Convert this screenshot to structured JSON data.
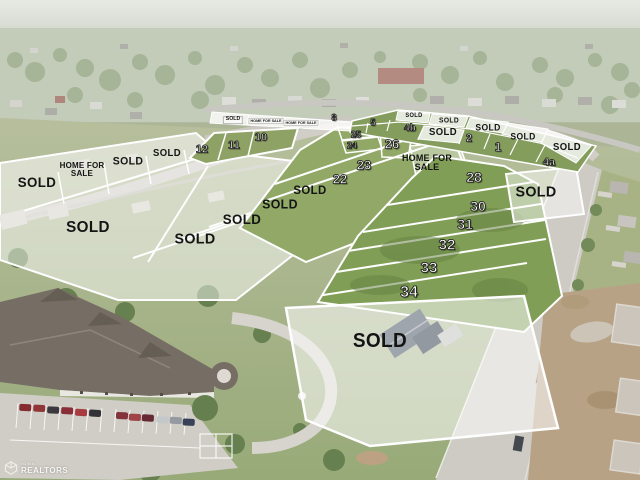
{
  "watermark": {
    "org_small": "IOWA",
    "org": "REALTORS"
  },
  "colors": {
    "lot_line": "#ffffff",
    "sold_overlay": "rgba(255,255,255,0.5)",
    "available_lot_green": "#7e9854",
    "label_black": "#141414",
    "lot_number_white": "#ffffff"
  },
  "labels": [
    {
      "text": "SOLD",
      "kind": "sign-sold",
      "x": 233,
      "y": 120,
      "size": 5.5
    },
    {
      "text": "HOME FOR SALE",
      "kind": "sign-hfs",
      "x": 266,
      "y": 121,
      "size": 6
    },
    {
      "text": "HOME FOR SALE",
      "kind": "sign-hfs",
      "x": 301,
      "y": 123,
      "size": 6
    },
    {
      "text": "8",
      "kind": "num",
      "x": 334,
      "y": 118,
      "size": 9
    },
    {
      "text": "5",
      "kind": "num",
      "x": 373,
      "y": 123,
      "size": 9
    },
    {
      "text": "SOLD",
      "kind": "sold",
      "x": 414,
      "y": 116,
      "size": 6
    },
    {
      "text": "4b",
      "kind": "num",
      "x": 410,
      "y": 129,
      "size": 10
    },
    {
      "text": "SOLD",
      "kind": "sold",
      "x": 449,
      "y": 121,
      "size": 7
    },
    {
      "text": "SOLD",
      "kind": "sold",
      "x": 443,
      "y": 133,
      "size": 10
    },
    {
      "text": "2",
      "kind": "num",
      "x": 469,
      "y": 139,
      "size": 11
    },
    {
      "text": "SOLD",
      "kind": "sold",
      "x": 488,
      "y": 128,
      "size": 9
    },
    {
      "text": "1",
      "kind": "num",
      "x": 498,
      "y": 147,
      "size": 12
    },
    {
      "text": "SOLD",
      "kind": "sold",
      "x": 523,
      "y": 137,
      "size": 9
    },
    {
      "text": "SOLD",
      "kind": "sold",
      "x": 567,
      "y": 148,
      "size": 10
    },
    {
      "text": "4a",
      "kind": "num",
      "x": 549,
      "y": 163,
      "size": 11
    },
    {
      "text": "10",
      "kind": "num",
      "x": 261,
      "y": 138,
      "size": 11
    },
    {
      "text": "11",
      "kind": "num",
      "x": 234,
      "y": 146,
      "size": 11
    },
    {
      "text": "12",
      "kind": "num",
      "x": 202,
      "y": 150,
      "size": 11
    },
    {
      "text": "SOLD",
      "kind": "sold",
      "x": 167,
      "y": 154,
      "size": 10
    },
    {
      "text": "SOLD",
      "kind": "sold",
      "x": 128,
      "y": 162,
      "size": 11
    },
    {
      "text": "HOME FOR\nSALE",
      "kind": "hfs",
      "x": 82,
      "y": 170,
      "size": 8
    },
    {
      "text": "SOLD",
      "kind": "sold",
      "x": 37,
      "y": 182,
      "size": 14
    },
    {
      "text": "SOLD",
      "kind": "sold",
      "x": 88,
      "y": 228,
      "size": 16
    },
    {
      "text": "SOLD",
      "kind": "sold",
      "x": 195,
      "y": 239,
      "size": 15
    },
    {
      "text": "SOLD",
      "kind": "sold",
      "x": 242,
      "y": 219,
      "size": 14
    },
    {
      "text": "SOLD",
      "kind": "sold",
      "x": 280,
      "y": 204,
      "size": 13
    },
    {
      "text": "SOLD",
      "kind": "sold",
      "x": 310,
      "y": 190,
      "size": 12
    },
    {
      "text": "25",
      "kind": "num",
      "x": 356,
      "y": 135,
      "size": 9
    },
    {
      "text": "24",
      "kind": "num",
      "x": 352,
      "y": 146,
      "size": 9
    },
    {
      "text": "26",
      "kind": "num",
      "x": 392,
      "y": 144,
      "size": 13
    },
    {
      "text": "23",
      "kind": "num",
      "x": 364,
      "y": 165,
      "size": 13
    },
    {
      "text": "22",
      "kind": "num",
      "x": 340,
      "y": 179,
      "size": 13
    },
    {
      "text": "HOME FOR\nSALE",
      "kind": "hfs",
      "x": 427,
      "y": 163,
      "size": 9
    },
    {
      "text": "28",
      "kind": "num",
      "x": 474,
      "y": 177,
      "size": 14
    },
    {
      "text": "30",
      "kind": "num",
      "x": 478,
      "y": 206,
      "size": 14
    },
    {
      "text": "31",
      "kind": "num",
      "x": 465,
      "y": 224,
      "size": 14
    },
    {
      "text": "32",
      "kind": "num",
      "x": 447,
      "y": 245,
      "size": 15
    },
    {
      "text": "33",
      "kind": "num",
      "x": 429,
      "y": 268,
      "size": 15
    },
    {
      "text": "34",
      "kind": "num",
      "x": 409,
      "y": 293,
      "size": 16
    },
    {
      "text": "SOLD",
      "kind": "sold",
      "x": 536,
      "y": 192,
      "size": 15
    },
    {
      "text": "SOLD",
      "kind": "sold",
      "x": 380,
      "y": 341,
      "size": 20
    }
  ]
}
